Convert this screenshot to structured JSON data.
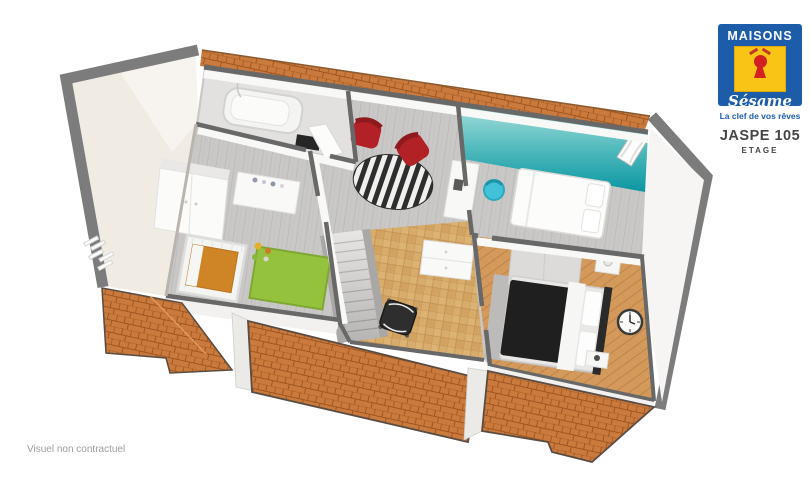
{
  "branding": {
    "logo": {
      "word_top": "MAISONS",
      "word_bottom": "Sésame",
      "tagline": "La clef de vos rêves",
      "colors": {
        "blue": "#1d5ca8",
        "yellow": "#f8c517",
        "red": "#d42020"
      }
    },
    "plan": {
      "title": "JASPE 105",
      "subtitle": "ETAGE"
    }
  },
  "footer": {
    "disclaimer": "Visuel non contractuel"
  },
  "floorplan": {
    "type": "3d-floorplan-render",
    "colors": {
      "roof_tile": "#cb7a3e",
      "fascia_gray": "#7c7c7c",
      "wood_floor_gray": "#c9c8c6",
      "parquet_light": "#d8ac6a",
      "parquet_dark": "#d39a5c",
      "teal_wall_dark": "#0c96a2",
      "teal_wall_light": "#a6dedb",
      "armchair_red": "#b22126",
      "rug_green": "#95c23c",
      "chair_cyan": "#41c2d6",
      "sloped_ceiling_cream": "#f0ece4"
    },
    "rooms": [
      "bathroom",
      "child-bedroom",
      "landing",
      "teal-bedroom",
      "office",
      "master-bedroom",
      "staircase"
    ]
  }
}
